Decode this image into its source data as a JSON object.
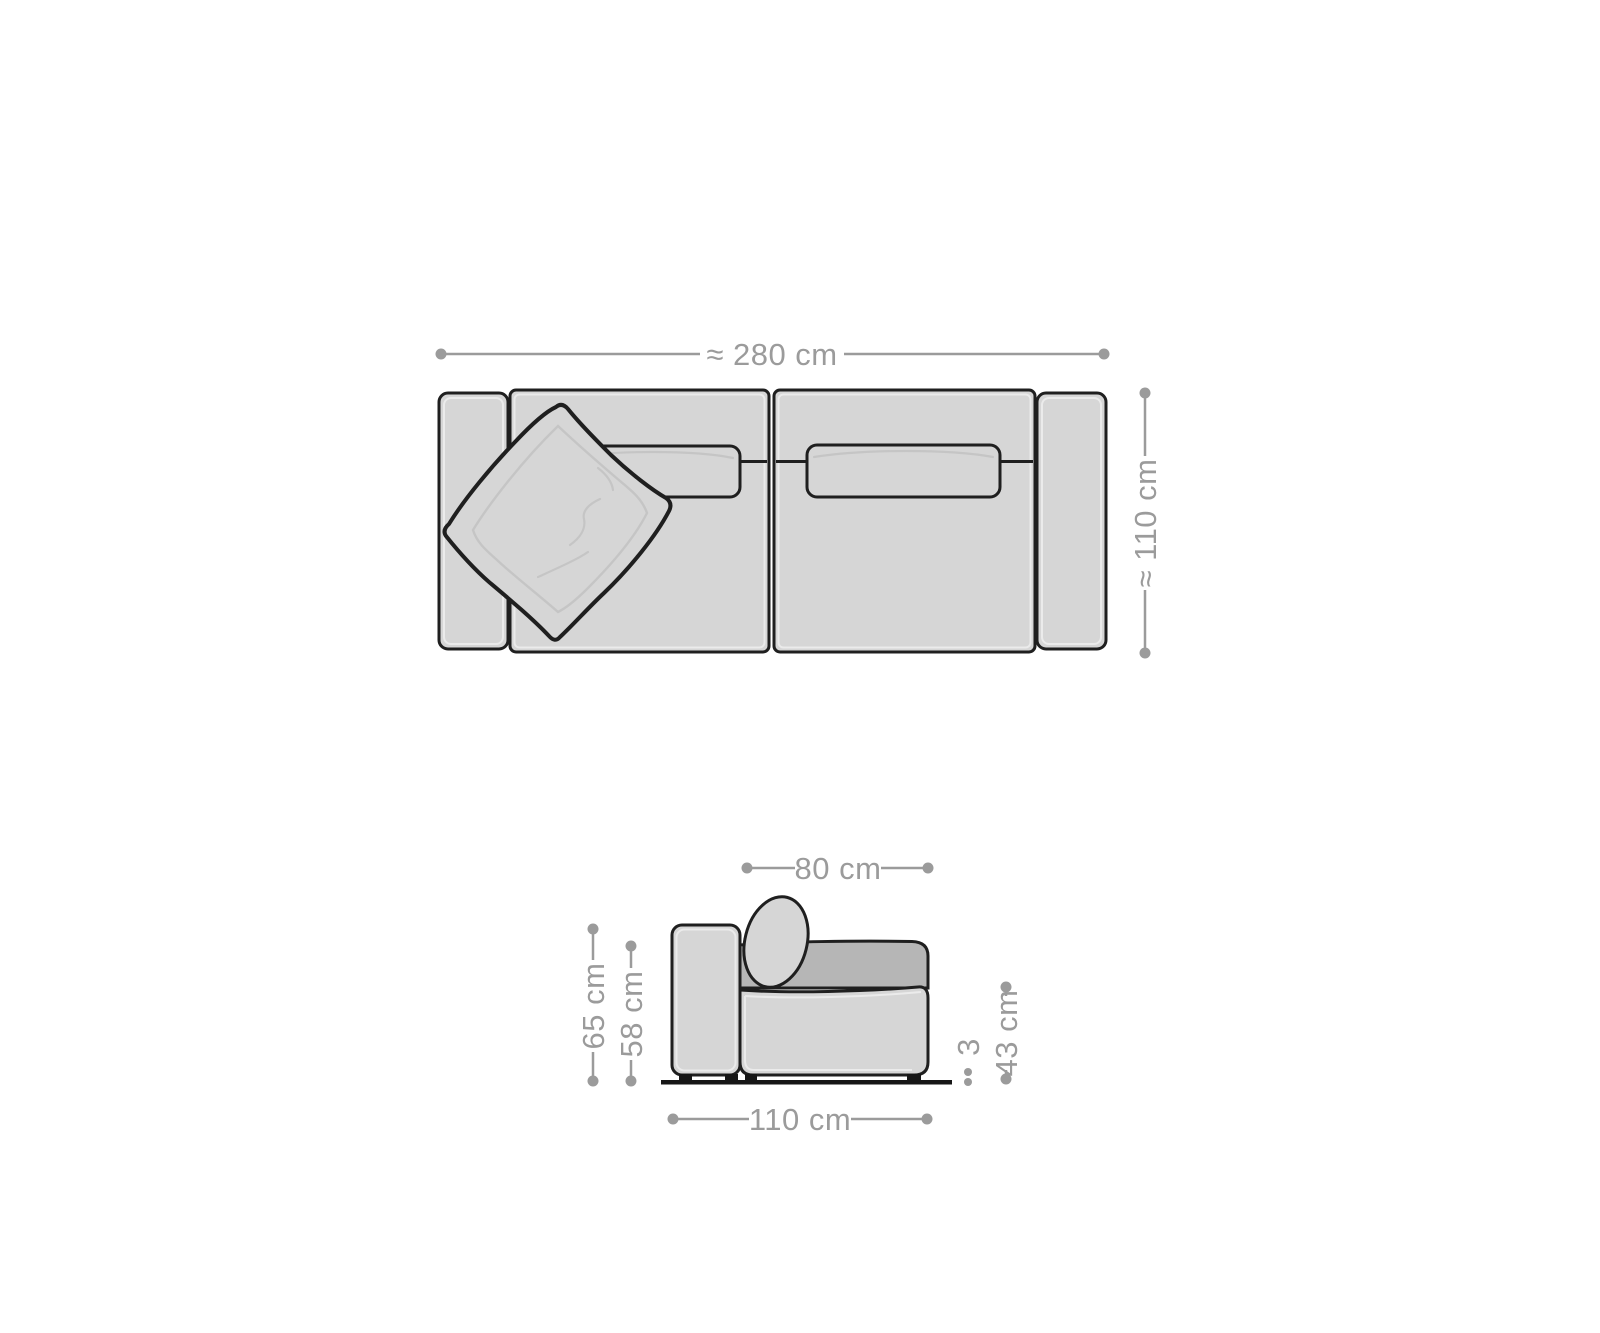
{
  "diagram": {
    "top_view": {
      "width_label": "≈ 280 cm",
      "depth_label": "≈ 110 cm"
    },
    "side_view": {
      "seat_depth_label": "80 cm",
      "total_height_label": "65 cm",
      "backrest_height_label": "58 cm",
      "seat_height_label": "43 cm",
      "foot_height_label": "3",
      "total_depth_label": "110 cm"
    }
  },
  "colors": {
    "background": "#ffffff",
    "outline": "#1f1f1f",
    "fill_light": "#d6d6d6",
    "fill_dark": "#b6b6b6",
    "inner_line": "#ebebeb",
    "crease_line": "#c5c5c5",
    "dimension_gray": "#9b9b9b",
    "foot_black": "#161616"
  }
}
